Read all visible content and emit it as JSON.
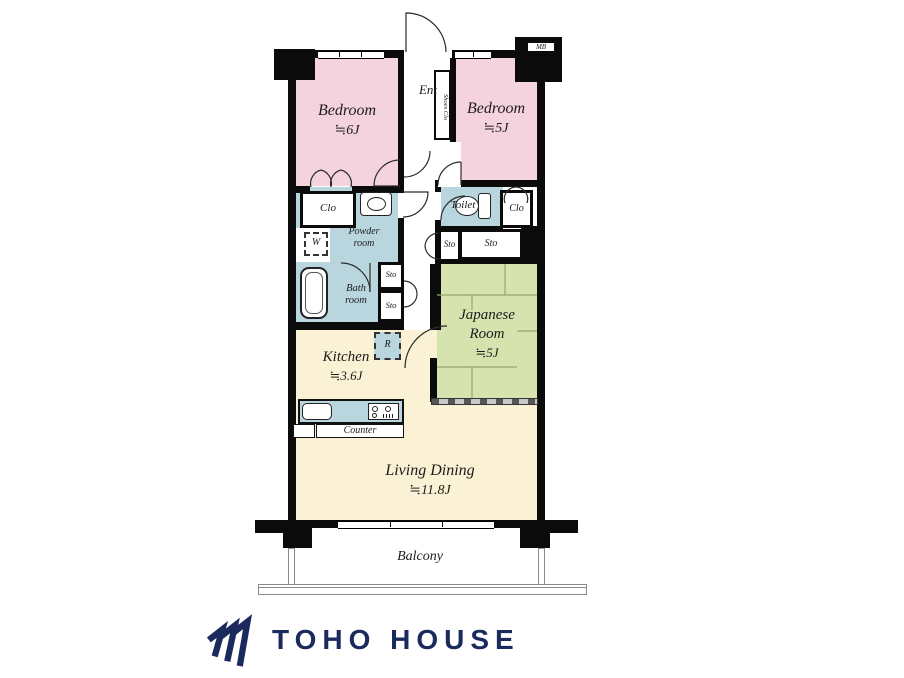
{
  "colors": {
    "pink": "#f5d3de",
    "wet-blue": "#b9d6de",
    "tatami-green": "#d6e3ae",
    "living-cream": "#fbf1d4",
    "navy": "#1b2a5c",
    "wall": "#0b0b0b"
  },
  "plan": {
    "ent": {
      "label": "Ent",
      "shoes_clo": "Shoes Clo",
      "meter_box": "MB"
    },
    "bedroom1": {
      "name": "Bedroom",
      "size": "≒6J"
    },
    "bedroom2": {
      "name": "Bedroom",
      "size": "≒5J"
    },
    "clo_left": "Clo",
    "clo_right": "Clo",
    "toilet": "Toilet",
    "powder": {
      "line1": "Powder",
      "line2": "room"
    },
    "washer": "W",
    "bath": {
      "line1": "Bath",
      "line2": "room"
    },
    "sto_right_small": "Sto",
    "sto_right_wide": "Sto",
    "sto_hall_upper": "Sto",
    "sto_hall_lower": "Sto",
    "japanese": {
      "line1": "Japanese",
      "line2": "Room",
      "size": "≒5J"
    },
    "kitchen": {
      "name": "Kitchen",
      "size": "≒3.6J"
    },
    "fridge": "R",
    "counter": "Counter",
    "living": {
      "name": "Living Dining",
      "size": "≒11.8J"
    },
    "balcony": "Balcony"
  },
  "branding": {
    "company": "TOHO HOUSE"
  }
}
